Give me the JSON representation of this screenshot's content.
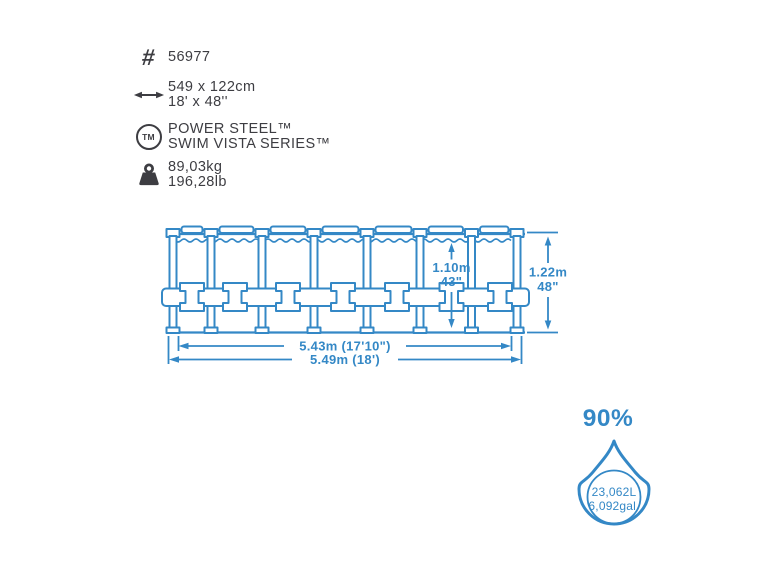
{
  "product": {
    "item_number": "56977",
    "size_metric": "549 x 122cm",
    "size_imperial": "18' x 48''",
    "series_line1": "POWER STEEL™",
    "series_line2": "SWIM VISTA SERIES™",
    "weight_metric": "89,03kg",
    "weight_imperial": "196,28lb"
  },
  "icons": {
    "hash": "#",
    "trademark": "TM"
  },
  "diagram": {
    "water_height_metric": "1.10m",
    "water_height_imperial": "43\"",
    "total_height_metric": "1.22m",
    "total_height_imperial": "48\"",
    "inner_diameter": "5.43m (17'10\")",
    "outer_diameter": "5.49m (18')"
  },
  "capacity": {
    "fill_percent": "90%",
    "volume_liters": "23,062L",
    "volume_gallons": "6,092gal."
  },
  "colors": {
    "accent_blue": "#3488c6",
    "ink": "#3d3d42",
    "background": "#ffffff"
  }
}
